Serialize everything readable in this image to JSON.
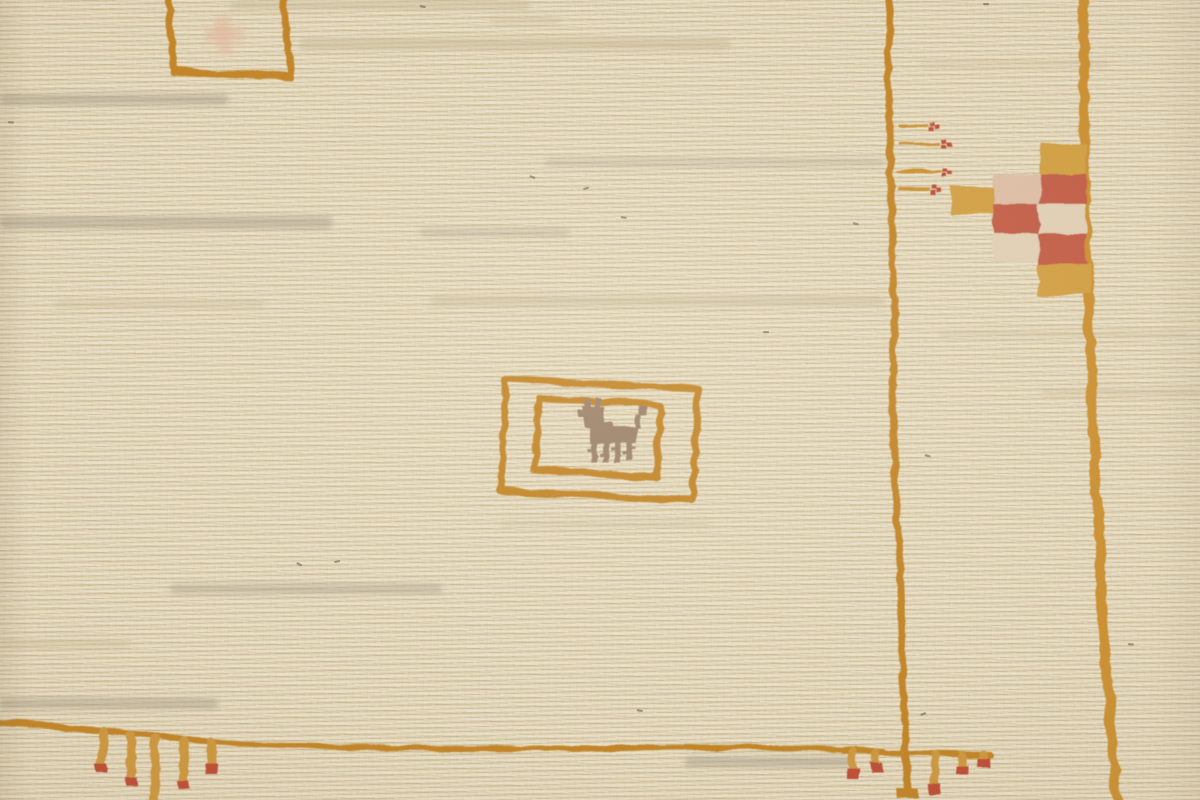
{
  "scene": {
    "type": "photograph",
    "subject": "Close-up detail of a handwoven cream wool gabbeh rug showing orange woven border lines, a small llama motif inside two nested rectangular frames, a red-pink-gold checkerboard medallion on the right border, sprigs with red berry dots, and fringed tassel combs with red tips along the bottom border",
    "canvas": {
      "width": 1200,
      "height": 800
    }
  },
  "palette": {
    "field": "#ebddbd",
    "row_light": "#f4ecd6",
    "row_dark": "#decfa9",
    "line_orange": "#c8831f",
    "line_gold": "#d2912a",
    "tassel_gold": "#d49939",
    "gold_block": "#d9a23e",
    "red": "#c85843",
    "red_deep": "#c2452f",
    "pink": "#e5c4ab",
    "cream_block": "#ead8bd",
    "animal_taupe": "#9c8068",
    "salmon": "#ecc0a4",
    "streak_gray": "#a79d8a",
    "streak_beige": "#cfc09c",
    "fleck_dark": "#57503f"
  },
  "border": {
    "thin_vertical_line": {
      "width": 7,
      "color_key": "line_orange",
      "points": [
        [
          888,
          -8
        ],
        [
          886,
          80
        ],
        [
          889,
          180
        ],
        [
          893,
          300
        ],
        [
          890,
          400
        ],
        [
          895,
          500
        ],
        [
          899,
          600
        ],
        [
          902,
          690
        ],
        [
          904,
          748
        ]
      ]
    },
    "thin_vertical_tail": {
      "width": 8,
      "color_key": "line_orange",
      "points": [
        [
          904,
          748
        ],
        [
          906,
          788
        ]
      ]
    },
    "thin_vertical_foot": {
      "rect": [
        894,
        786,
        22,
        11
      ],
      "color_key": "line_orange"
    },
    "thick_vertical_line": {
      "width": 10,
      "color_key": "line_gold",
      "points": [
        [
          1082,
          -8
        ],
        [
          1082,
          120
        ],
        [
          1085,
          240
        ],
        [
          1088,
          330
        ],
        [
          1092,
          430
        ],
        [
          1098,
          540
        ],
        [
          1104,
          640
        ],
        [
          1110,
          730
        ],
        [
          1116,
          806
        ]
      ]
    },
    "bottom_horizontal_line": {
      "width": 6,
      "color_key": "line_orange",
      "points": [
        [
          -8,
          721
        ],
        [
          60,
          725
        ],
        [
          150,
          733
        ],
        [
          240,
          742
        ],
        [
          360,
          746
        ],
        [
          560,
          747
        ],
        [
          760,
          745
        ],
        [
          882,
          749
        ]
      ]
    },
    "comb_bar": {
      "width": 6,
      "color_key": "line_orange",
      "points": [
        [
          842,
          749
        ],
        [
          905,
          751
        ],
        [
          988,
          753
        ]
      ]
    }
  },
  "motifs": {
    "top_left_frame": {
      "quad": [
        [
          167,
          -10
        ],
        [
          280,
          -10
        ],
        [
          289,
          76
        ],
        [
          171,
          69
        ]
      ],
      "stroke": 7,
      "color_key": "line_orange",
      "inner_salmon_cross": {
        "rects": [
          [
            215,
            12,
            15,
            42
          ],
          [
            202,
            25,
            42,
            15
          ]
        ],
        "color_key": "salmon",
        "opacity": 0.55
      }
    },
    "center_frames": {
      "outer_quad": [
        [
          504,
          377
        ],
        [
          696,
          387
        ],
        [
          691,
          499
        ],
        [
          499,
          489
        ]
      ],
      "inner_quad": [
        [
          537,
          396
        ],
        [
          659,
          404
        ],
        [
          654,
          476
        ],
        [
          533,
          468
        ]
      ],
      "stroke": 7,
      "color_key": "line_orange"
    },
    "animal": {
      "color_key": "animal_taupe",
      "rects": [
        [
          582,
          405,
          20,
          21
        ],
        [
          584,
          397,
          5,
          9
        ],
        [
          593,
          395,
          5,
          11
        ],
        [
          577,
          409,
          6,
          6
        ],
        [
          597,
          419,
          13,
          9
        ],
        [
          587,
          424,
          48,
          17
        ],
        [
          633,
          413,
          5,
          13
        ],
        [
          636,
          406,
          8,
          8
        ],
        [
          589,
          441,
          6,
          20
        ],
        [
          601,
          441,
          6,
          19
        ],
        [
          613,
          441,
          6,
          20
        ],
        [
          625,
          441,
          6,
          19
        ],
        [
          585,
          446,
          4,
          3
        ],
        [
          597,
          451,
          4,
          3
        ],
        [
          609,
          446,
          4,
          3
        ],
        [
          621,
          451,
          4,
          3
        ],
        [
          631,
          446,
          4,
          3
        ]
      ]
    },
    "checkerboard": {
      "squares": [
        [
          1038,
          142,
          47,
          31,
          "gold_block"
        ],
        [
          1038,
          172,
          47,
          31,
          "red"
        ],
        [
          991,
          172,
          48,
          31,
          "pink"
        ],
        [
          949,
          186,
          43,
          27,
          "gold_block"
        ],
        [
          991,
          202,
          48,
          31,
          "red"
        ],
        [
          1038,
          202,
          47,
          31,
          "cream_block"
        ],
        [
          991,
          232,
          48,
          27,
          "cream_block"
        ],
        [
          1038,
          232,
          47,
          31,
          "red"
        ],
        [
          1037,
          262,
          52,
          32,
          "gold_block"
        ]
      ]
    },
    "sprigs": {
      "stem_width": 3,
      "stem_color_key": "line_gold",
      "dot_color_key": "red_deep",
      "items": [
        {
          "y": 124,
          "x1": 897,
          "x2": 924,
          "dot": [
            927,
            121
          ]
        },
        {
          "y": 142,
          "x1": 897,
          "x2": 936,
          "dot": [
            939,
            138
          ]
        },
        {
          "y": 169,
          "x1": 897,
          "x2": 938,
          "dot": [
            941,
            166
          ]
        },
        {
          "y": 188,
          "x1": 897,
          "x2": 926,
          "dot": [
            929,
            184
          ]
        }
      ]
    },
    "bottom_left_tassels": {
      "stem_width": 9,
      "stem_color_key": "tassel_gold",
      "tip_color_key": "red_deep",
      "items": [
        {
          "x": 101,
          "y1": 729,
          "y2": 763,
          "tip": true
        },
        {
          "x": 129,
          "y1": 733,
          "y2": 778,
          "tip": true
        },
        {
          "x": 153,
          "y1": 736,
          "y2": 806,
          "tip": false
        },
        {
          "x": 182,
          "y1": 738,
          "y2": 780,
          "tip": true
        },
        {
          "x": 209,
          "y1": 739,
          "y2": 764,
          "tip": true
        }
      ]
    },
    "bottom_right_tassels": {
      "stem_width": 8,
      "stem_color_key": "tassel_gold",
      "tip_color_key": "red_deep",
      "items": [
        {
          "x": 851,
          "y1": 750,
          "y2": 768,
          "tip": true
        },
        {
          "x": 875,
          "y1": 750,
          "y2": 762,
          "tip": true
        },
        {
          "x": 933,
          "y1": 753,
          "y2": 784,
          "tip": true
        },
        {
          "x": 961,
          "y1": 753,
          "y2": 766,
          "tip": true
        },
        {
          "x": 982,
          "y1": 753,
          "y2": 758,
          "tip": true
        }
      ]
    }
  },
  "texture": {
    "streaks": [
      [
        230,
        0,
        300,
        10,
        "streak_beige",
        0.5
      ],
      [
        300,
        38,
        430,
        12,
        "streak_beige",
        0.55
      ],
      [
        490,
        16,
        70,
        9,
        "streak_beige",
        0.35
      ],
      [
        0,
        94,
        228,
        11,
        "streak_gray",
        0.5
      ],
      [
        545,
        158,
        340,
        9,
        "streak_gray",
        0.28
      ],
      [
        0,
        216,
        332,
        13,
        "streak_gray",
        0.5
      ],
      [
        420,
        228,
        150,
        9,
        "streak_gray",
        0.3
      ],
      [
        430,
        296,
        455,
        10,
        "streak_beige",
        0.5
      ],
      [
        55,
        300,
        210,
        8,
        "streak_beige",
        0.4
      ],
      [
        920,
        60,
        190,
        8,
        "streak_beige",
        0.3
      ],
      [
        1040,
        388,
        160,
        9,
        "streak_beige",
        0.35
      ],
      [
        940,
        330,
        250,
        8,
        "streak_beige",
        0.3
      ],
      [
        170,
        584,
        272,
        10,
        "streak_gray",
        0.42
      ],
      [
        0,
        640,
        130,
        8,
        "streak_beige",
        0.4
      ],
      [
        500,
        520,
        210,
        8,
        "streak_beige",
        0.28
      ],
      [
        0,
        698,
        218,
        11,
        "streak_gray",
        0.45
      ],
      [
        685,
        757,
        168,
        10,
        "streak_gray",
        0.5
      ]
    ],
    "flecks": [
      [
        420,
        5,
        10
      ],
      [
        983,
        3,
        0
      ],
      [
        8,
        121,
        5
      ],
      [
        530,
        175,
        20
      ],
      [
        583,
        188,
        -15
      ],
      [
        621,
        216,
        8
      ],
      [
        763,
        331,
        0
      ],
      [
        853,
        222,
        12
      ],
      [
        297,
        562,
        25
      ],
      [
        334,
        561,
        -10
      ],
      [
        925,
        454,
        15
      ],
      [
        1128,
        643,
        5
      ],
      [
        920,
        714,
        -20
      ],
      [
        637,
        709,
        10
      ]
    ]
  }
}
